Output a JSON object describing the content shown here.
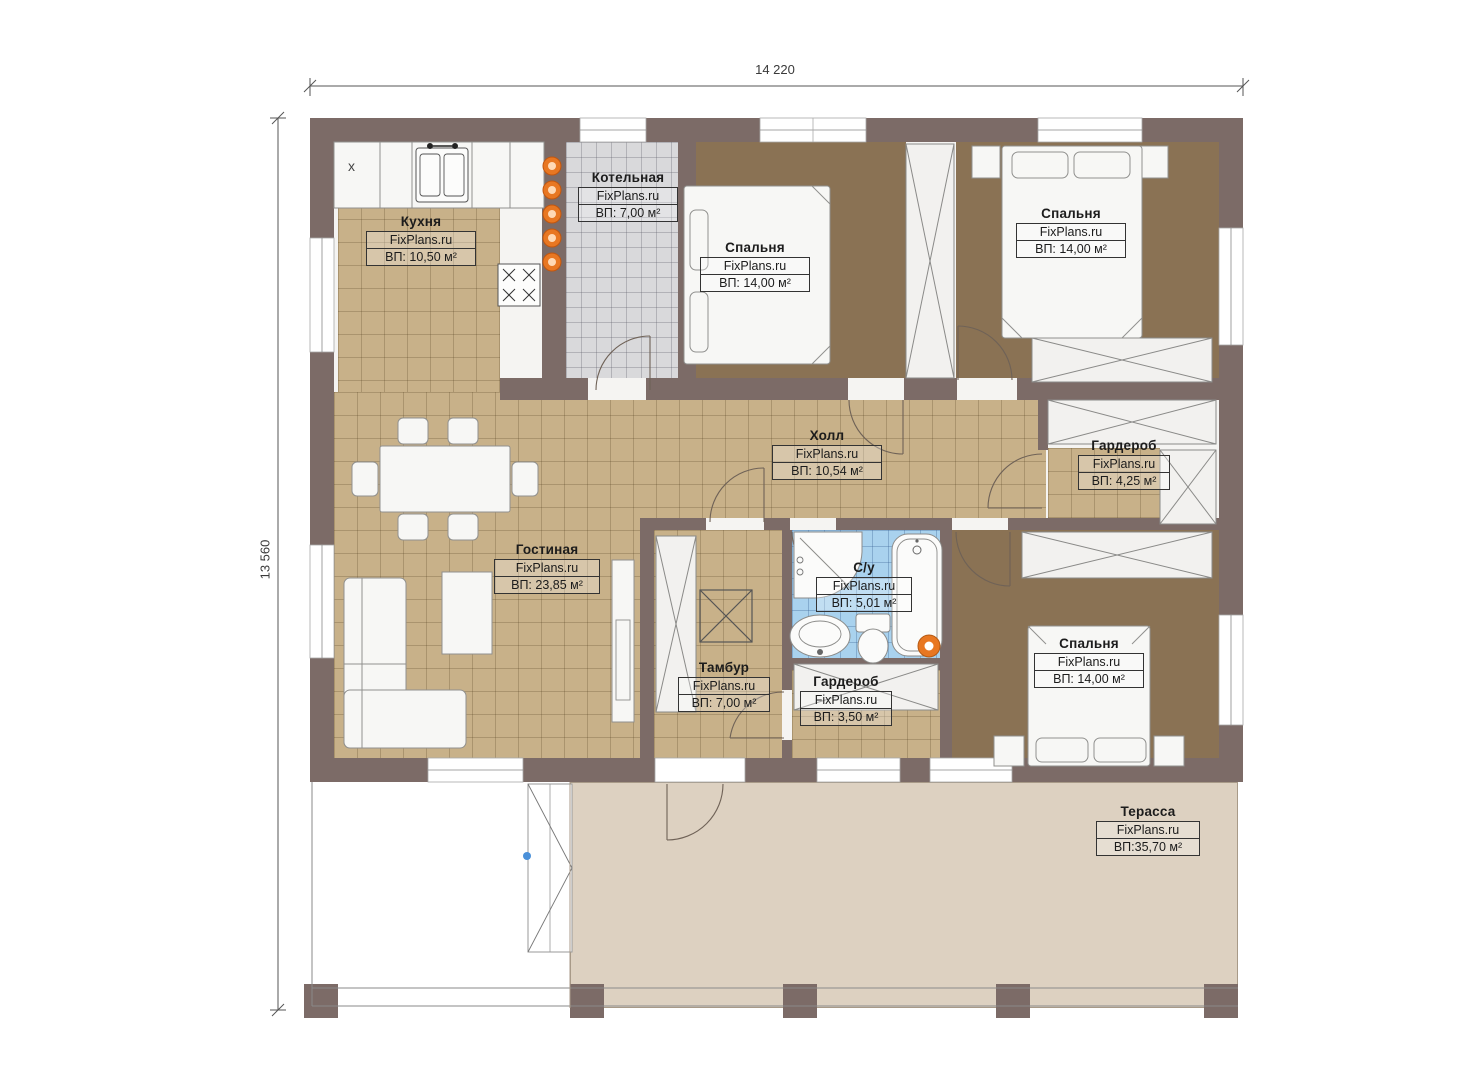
{
  "plan": {
    "brand": "FixPlans.ru",
    "dim_width": "14 220",
    "dim_height": "13 560",
    "kitchen_marker": "x",
    "rooms": [
      {
        "name": "Кухня",
        "area": "ВП: 10,50 м²"
      },
      {
        "name": "Котельная",
        "area": "ВП: 7,00 м²"
      },
      {
        "name": "Спальня",
        "area": "ВП: 14,00 м²"
      },
      {
        "name": "Спальня",
        "area": "ВП: 14,00 м²"
      },
      {
        "name": "Холл",
        "area": "ВП: 10,54 м²"
      },
      {
        "name": "Гардероб",
        "area": "ВП: 4,25 м²"
      },
      {
        "name": "Гостиная",
        "area": "ВП: 23,85 м²"
      },
      {
        "name": "Тамбур",
        "area": "ВП: 7,00 м²"
      },
      {
        "name": "С/у",
        "area": "ВП: 5,01 м²"
      },
      {
        "name": "Гардероб",
        "area": "ВП: 3,50 м²"
      },
      {
        "name": "Спальня",
        "area": "ВП: 14,00 м²"
      },
      {
        "name": "Терасса",
        "area": "ВП:35,70 м²"
      }
    ],
    "colors": {
      "wall": "#7c6b67",
      "floor_tile": "#c8b189",
      "floor_carpet": "#8a7254",
      "floor_boiler": "#d9d9db",
      "floor_bath": "#a9d2ee",
      "terrace": "#ddd1c1",
      "equipment_orange": "#e87722"
    }
  }
}
